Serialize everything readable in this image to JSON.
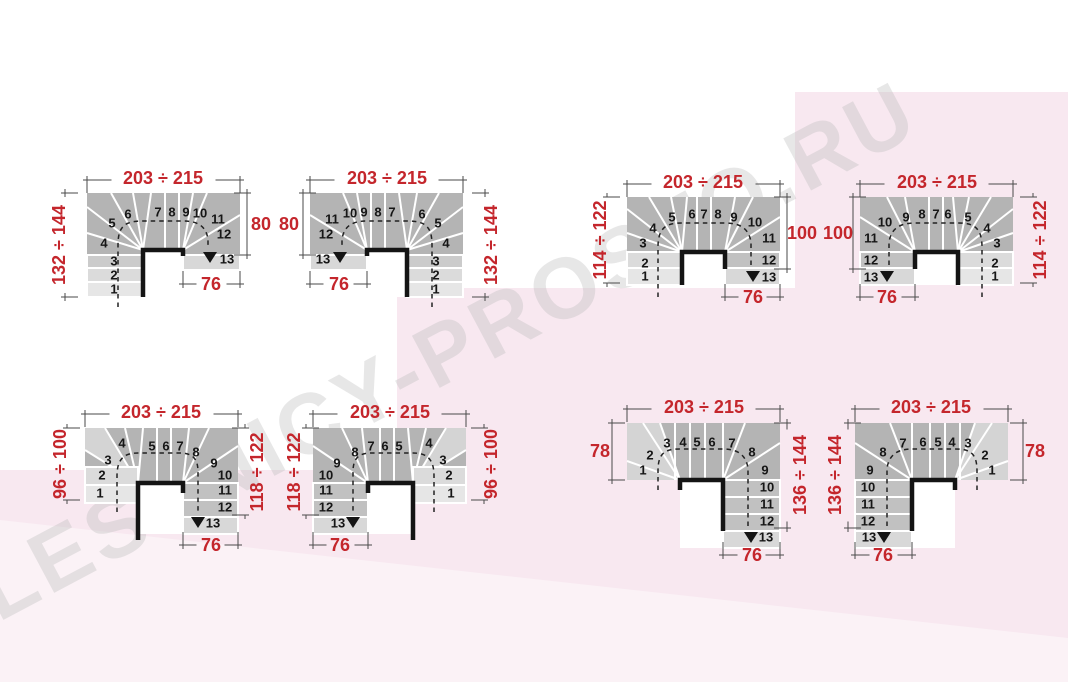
{
  "watermark": {
    "text": "LESTNICY-PROSTO.RU"
  },
  "colors": {
    "dimension_red": "#c4262c",
    "pink_background": "#f8e8f0",
    "stair_gray": "#b4b4b4",
    "light_step_gray": "#e6e6e6"
  },
  "diagrams": [
    {
      "name": "top-row-left",
      "dim_top": "203 ÷ 215",
      "dim_left": "132 ÷ 144",
      "dim_right": "80",
      "dim_bottom": "76",
      "steps": [
        "1",
        "2",
        "3",
        "4",
        "5",
        "6",
        "7",
        "8",
        "9",
        "10",
        "11",
        "12",
        "13"
      ]
    },
    {
      "name": "top-row-second",
      "dim_top": "203 ÷ 215",
      "dim_left": "80",
      "dim_right": "132 ÷ 144",
      "dim_bottom": "76",
      "steps": [
        "1",
        "2",
        "3",
        "4",
        "5",
        "6",
        "7",
        "8",
        "9",
        "10",
        "11",
        "12",
        "13"
      ]
    },
    {
      "name": "top-row-third",
      "dim_top": "203 ÷ 215",
      "dim_left": "114 ÷ 122",
      "dim_right": "100",
      "dim_bottom": "76",
      "steps": [
        "1",
        "2",
        "3",
        "4",
        "5",
        "6",
        "7",
        "8",
        "9",
        "10",
        "11",
        "12",
        "13"
      ]
    },
    {
      "name": "top-row-right",
      "dim_top": "203 ÷ 215",
      "dim_left": "100",
      "dim_right": "114 ÷ 122",
      "dim_bottom": "76",
      "steps": [
        "1",
        "2",
        "3",
        "4",
        "5",
        "6",
        "7",
        "8",
        "9",
        "10",
        "11",
        "12",
        "13"
      ]
    },
    {
      "name": "bottom-row-left",
      "dim_top": "203 ÷ 215",
      "dim_left": "96 ÷ 100",
      "dim_right": "118 ÷ 122",
      "dim_bottom": "76",
      "steps": [
        "1",
        "2",
        "3",
        "4",
        "5",
        "6",
        "7",
        "8",
        "9",
        "10",
        "11",
        "12",
        "13"
      ]
    },
    {
      "name": "bottom-row-second",
      "dim_top": "203 ÷ 215",
      "dim_left": "118 ÷ 122",
      "dim_right": "96 ÷ 100",
      "dim_bottom": "76",
      "steps": [
        "1",
        "2",
        "3",
        "4",
        "5",
        "6",
        "7",
        "8",
        "9",
        "10",
        "11",
        "12",
        "13"
      ]
    },
    {
      "name": "bottom-row-third",
      "dim_top": "203 ÷ 215",
      "dim_left": "78",
      "dim_right": "136 ÷ 144",
      "dim_bottom": "76",
      "steps": [
        "1",
        "2",
        "3",
        "4",
        "5",
        "6",
        "7",
        "8",
        "9",
        "10",
        "11",
        "12",
        "13"
      ]
    },
    {
      "name": "bottom-row-right",
      "dim_top": "203 ÷ 215",
      "dim_left": "136 ÷ 144",
      "dim_right": "78",
      "dim_bottom": "76",
      "steps": [
        "1",
        "2",
        "3",
        "4",
        "5",
        "6",
        "7",
        "8",
        "9",
        "10",
        "11",
        "12",
        "13"
      ]
    }
  ]
}
